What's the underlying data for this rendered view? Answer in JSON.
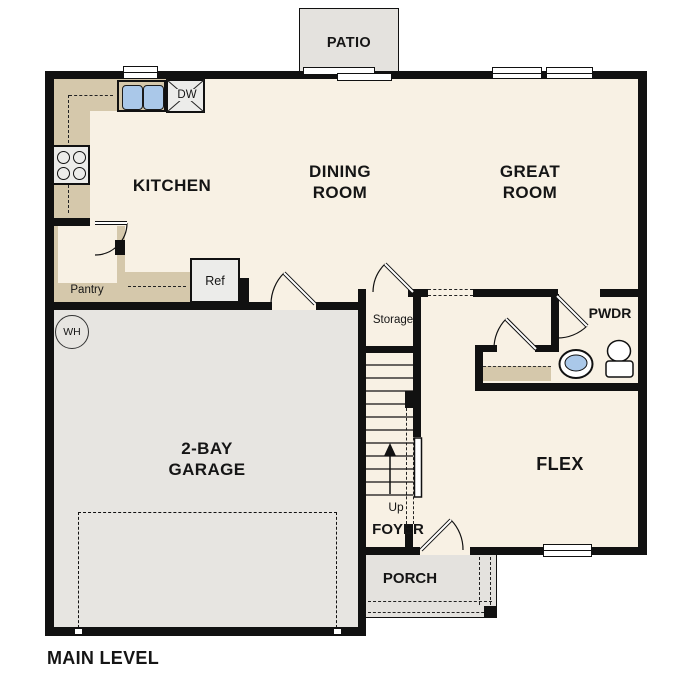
{
  "plan": {
    "title": "MAIN LEVEL",
    "rooms": {
      "patio": "PATIO",
      "kitchen": "KITCHEN",
      "dining_line1": "DINING",
      "dining_line2": "ROOM",
      "great_line1": "GREAT",
      "great_line2": "ROOM",
      "garage_line1": "2-BAY",
      "garage_line2": "GARAGE",
      "flex": "FLEX",
      "foyer": "FOYER",
      "porch": "PORCH",
      "pwdr": "PWDR",
      "storage": "Storage",
      "pantry": "Pantry"
    },
    "labels": {
      "refrigerator": "Ref",
      "dishwasher": "DW",
      "water_heater": "WH",
      "stairs_direction": "Up"
    },
    "colors": {
      "floor": "#f8f1e4",
      "garage_floor": "#e7e5e1",
      "outdoor_concrete": "#e4e2de",
      "counter": "#d5c8ab",
      "sink_blue": "#aac8e9",
      "wall": "#111111"
    }
  }
}
